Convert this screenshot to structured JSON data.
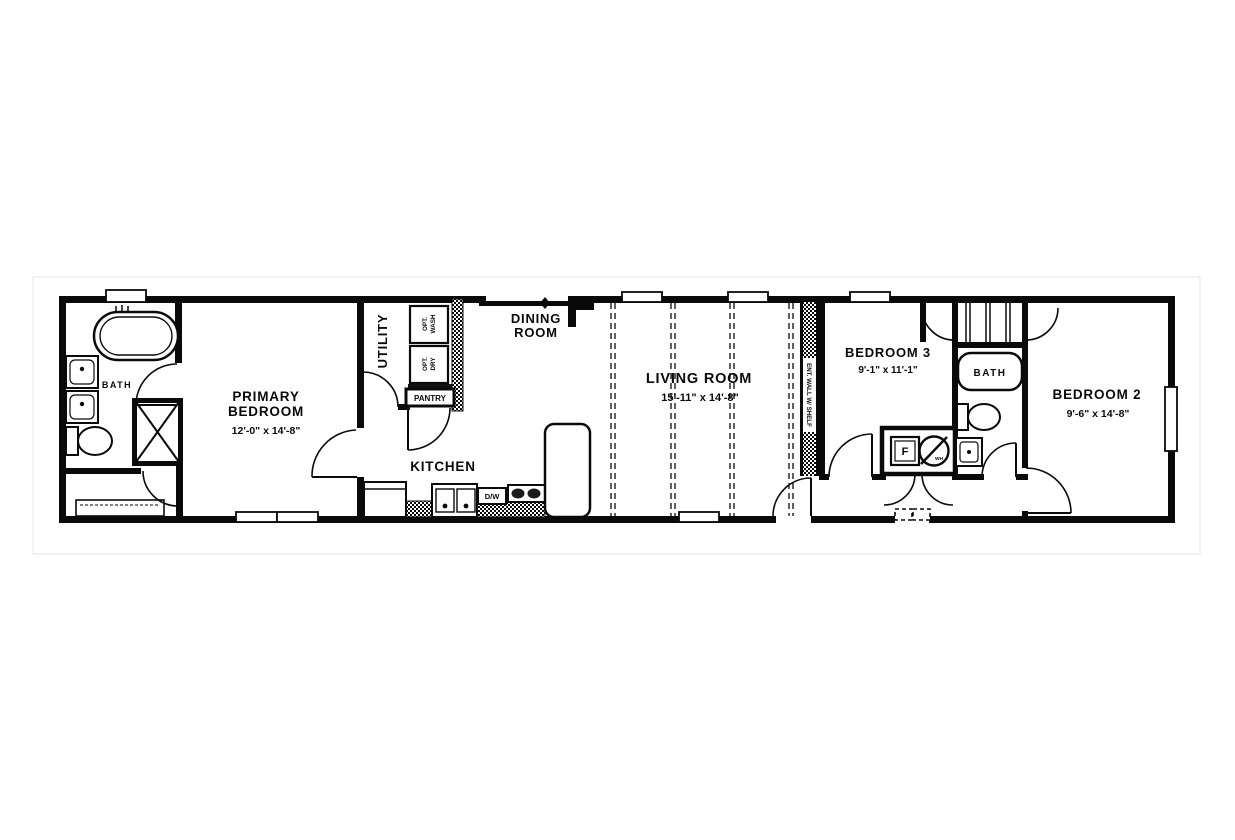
{
  "floorplan": {
    "rooms": {
      "bath_primary": {
        "label": "BATH"
      },
      "primary_bedroom": {
        "label_line1": "PRIMARY",
        "label_line2": "BEDROOM",
        "dims": "12'-0\" x  14'-8\""
      },
      "utility": {
        "label": "UTILITY"
      },
      "kitchen": {
        "label": "KITCHEN"
      },
      "dining_room": {
        "label_line1": "DINING",
        "label_line2": "ROOM"
      },
      "living_room": {
        "label": "LIVING ROOM",
        "dims": "15'-11\" x  14'-8\""
      },
      "bedroom3": {
        "label": "BEDROOM 3",
        "dims": "9'-1\" x  11'-1\""
      },
      "bath_hall": {
        "label": "BATH"
      },
      "bedroom2": {
        "label": "BEDROOM 2",
        "dims": "9'-6\" x  14'-8\""
      }
    },
    "fixtures": {
      "pantry": {
        "label": "PANTRY"
      },
      "opt_wash": {
        "label_line1": "OPT.",
        "label_line2": "WASH"
      },
      "opt_dry": {
        "label_line1": "OPT.",
        "label_line2": "DRY"
      },
      "dishwasher": {
        "label": "D/W"
      },
      "furnace": {
        "label": "F"
      },
      "water_heater": {
        "label": "WH"
      },
      "ent_wall": {
        "label": "ENT. WALL W/ SHELF"
      }
    },
    "colors": {
      "wall": "#0a0a0a",
      "background": "#ffffff"
    }
  }
}
